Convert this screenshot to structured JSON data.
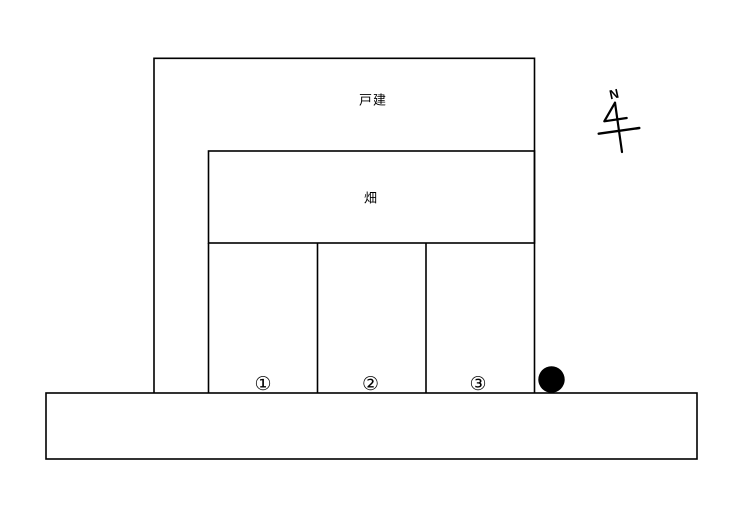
{
  "page": {
    "background_color": "#ffffff",
    "line_color": "#000000"
  },
  "plan": {
    "house_parcel": {
      "label": "戸建"
    },
    "field_parcel": {
      "label": "畑"
    },
    "parking_lots": [
      {
        "label": "①"
      },
      {
        "label": "②"
      },
      {
        "label": "③"
      }
    ],
    "compass": {
      "north_label": "N"
    },
    "marker": {
      "shape": "filled-circle",
      "color": "#000000"
    }
  }
}
